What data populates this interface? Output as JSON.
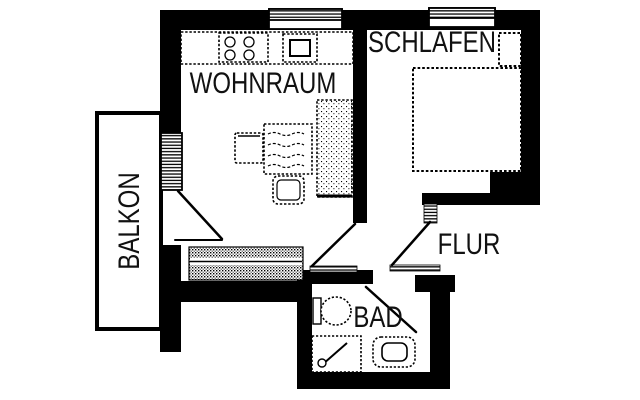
{
  "title": "apartment-floor-plan",
  "colors": {
    "wall": "#000000",
    "background": "#ffffff",
    "text": "#111111"
  },
  "rooms": {
    "wohnraum": {
      "label": "WOHNRAUM",
      "fixtures": [
        "kitchen-counter",
        "stove",
        "kitchen-sink",
        "sofa",
        "armchair",
        "coffee-table",
        "wardrobe",
        "radiator",
        "balcony-door",
        "window"
      ]
    },
    "schlafen": {
      "label": "SCHLAFEN",
      "fixtures": [
        "double-bed",
        "nightstand",
        "window"
      ]
    },
    "flur": {
      "label": "FLUR",
      "fixtures": [
        "door-to-wohnraum",
        "door-to-schlafen",
        "door-to-bad",
        "entry-threshold"
      ]
    },
    "bad": {
      "label": "BAD",
      "fixtures": [
        "toilet",
        "shower",
        "washbasin"
      ]
    },
    "balkon": {
      "label": "BALKON",
      "fixtures": []
    }
  }
}
